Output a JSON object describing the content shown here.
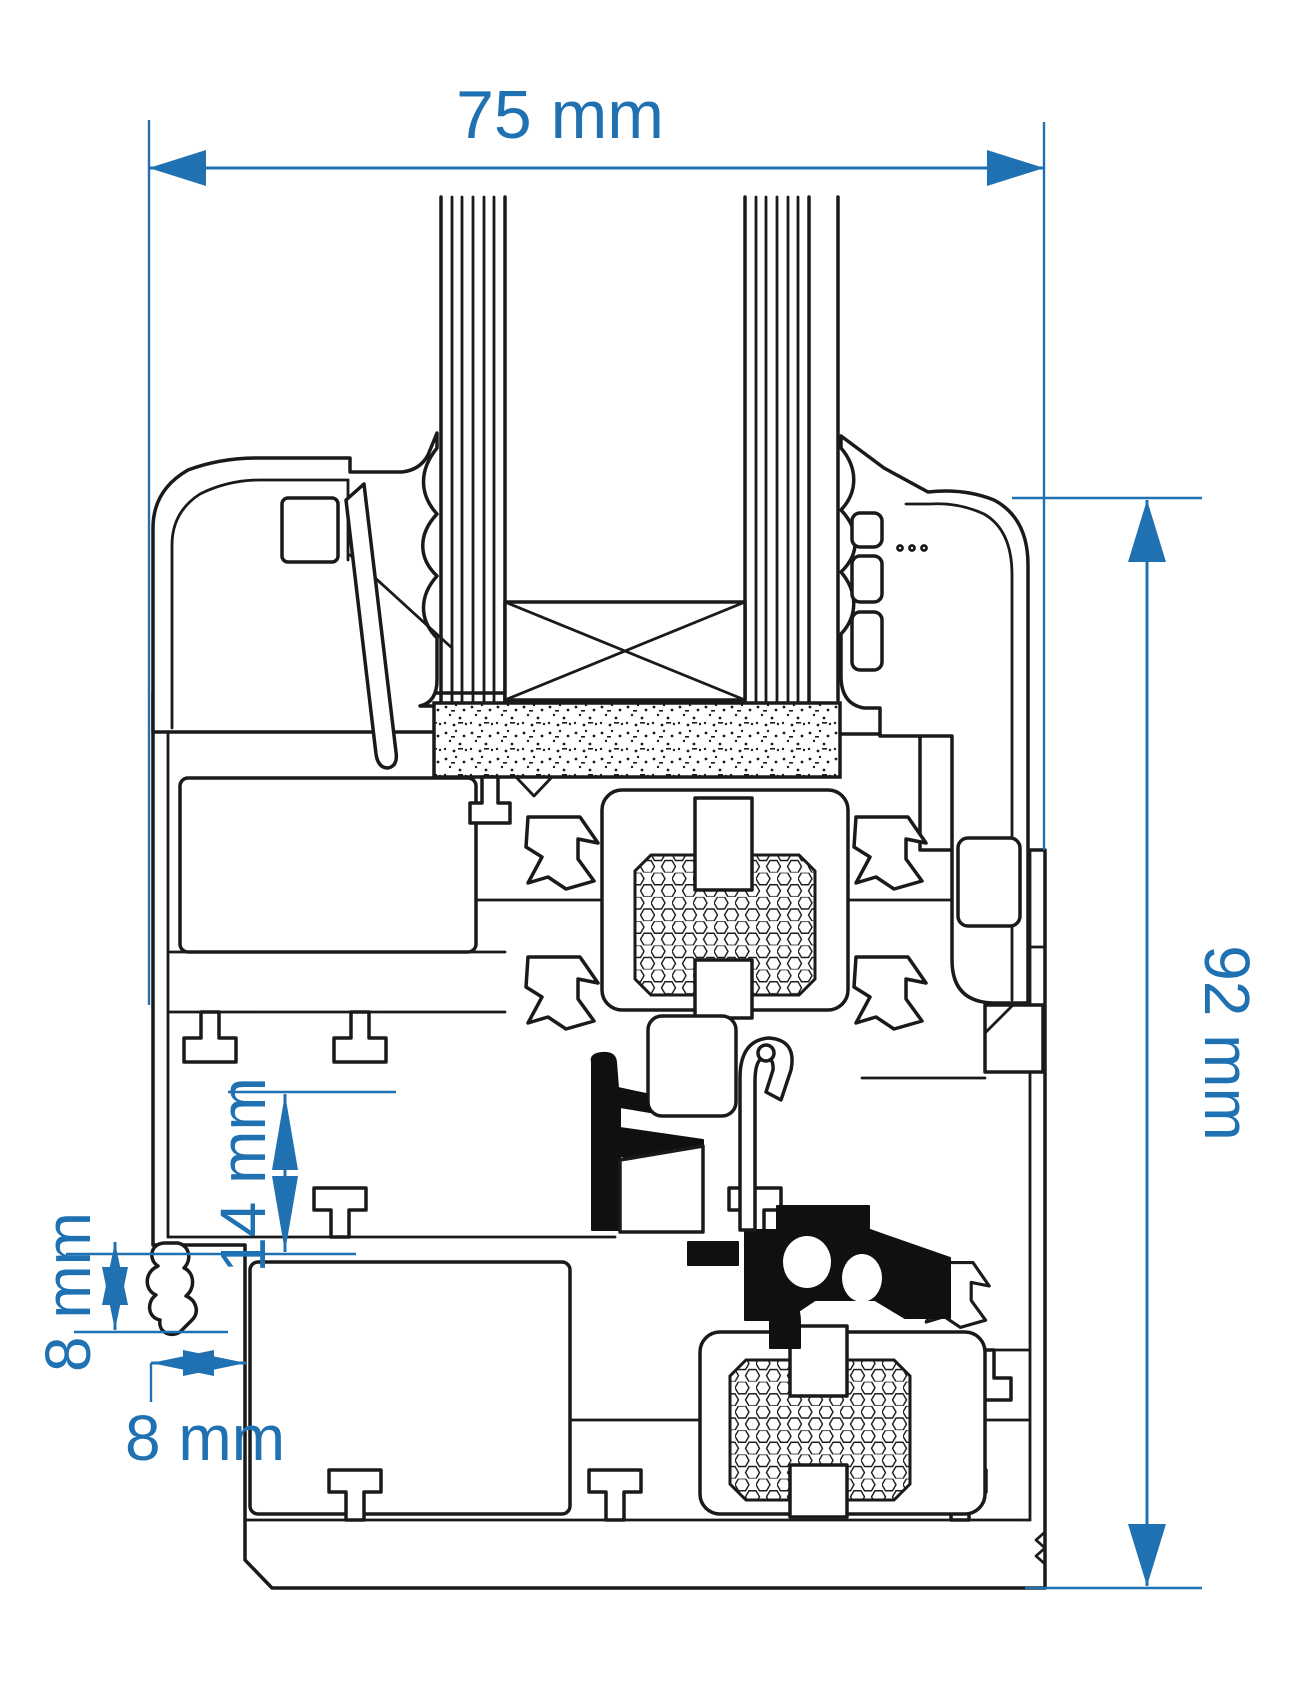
{
  "diagram": {
    "type": "technical-drawing",
    "subject": "window-profile-cross-section",
    "colors": {
      "dimension": "#2071b2",
      "outline": "#1a1a1a",
      "background": "#ffffff",
      "seal_fill": "#101010"
    },
    "dimensions": {
      "overall_width": {
        "label": "75 mm",
        "value": 75,
        "unit": "mm",
        "orientation": "horizontal",
        "position": "top"
      },
      "overall_depth": {
        "label": "92 mm",
        "value": 92,
        "unit": "mm",
        "orientation": "vertical",
        "position": "right"
      },
      "rebate_height": {
        "label": "14 mm",
        "value": 14,
        "unit": "mm",
        "orientation": "vertical",
        "position": "left-center"
      },
      "seal_height": {
        "label": "8 mm",
        "value": 8,
        "unit": "mm",
        "orientation": "vertical",
        "position": "left-bottom"
      },
      "seal_offset": {
        "label": "8 mm",
        "value": 8,
        "unit": "mm",
        "orientation": "horizontal",
        "position": "bottom-left"
      }
    }
  }
}
